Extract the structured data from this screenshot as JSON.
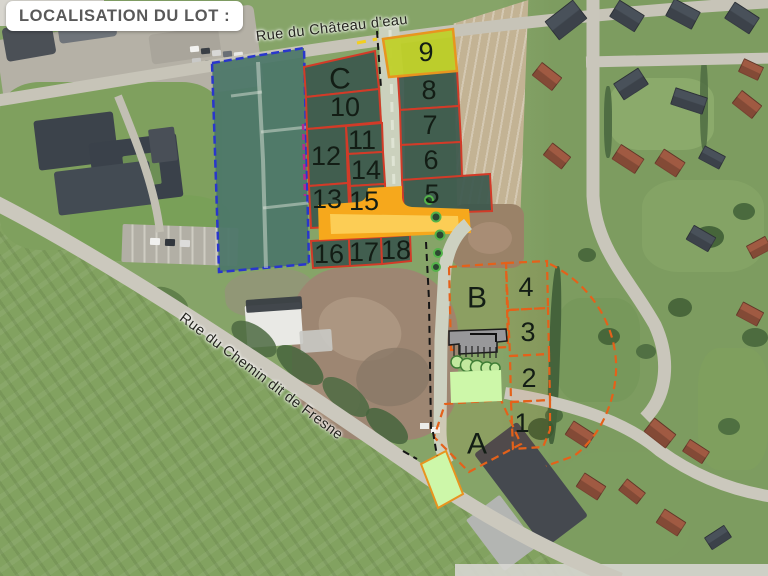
{
  "title": "LOCALISATION DU LOT :",
  "streets": {
    "chateau": "Rue du Château d'eau",
    "fresne": "Rue du Chemin dit de Fresne"
  },
  "highlighted_lot": "9",
  "lots": {
    "C": "C",
    "9": "9",
    "10": "10",
    "8": "8",
    "12": "12",
    "11": "11",
    "7": "7",
    "14": "14",
    "6": "6",
    "13": "13",
    "15": "15",
    "5": "5",
    "16": "16",
    "17": "17",
    "18": "18",
    "B": "B",
    "4": "4",
    "3": "3",
    "2": "2",
    "1": "1",
    "A": "A"
  },
  "colors": {
    "lot_fill": "#3c584d",
    "lot_border_red": "#d23b28",
    "highlight_fill": "#bfd029",
    "highlight_border": "#e8951f",
    "zone_border_blue": "#2936cc",
    "cluster_border_orange": "#e4611a",
    "junction_yellow": "#f6a81c",
    "green_area": "#cdf7a9",
    "purple_border": "#b12d8e"
  }
}
